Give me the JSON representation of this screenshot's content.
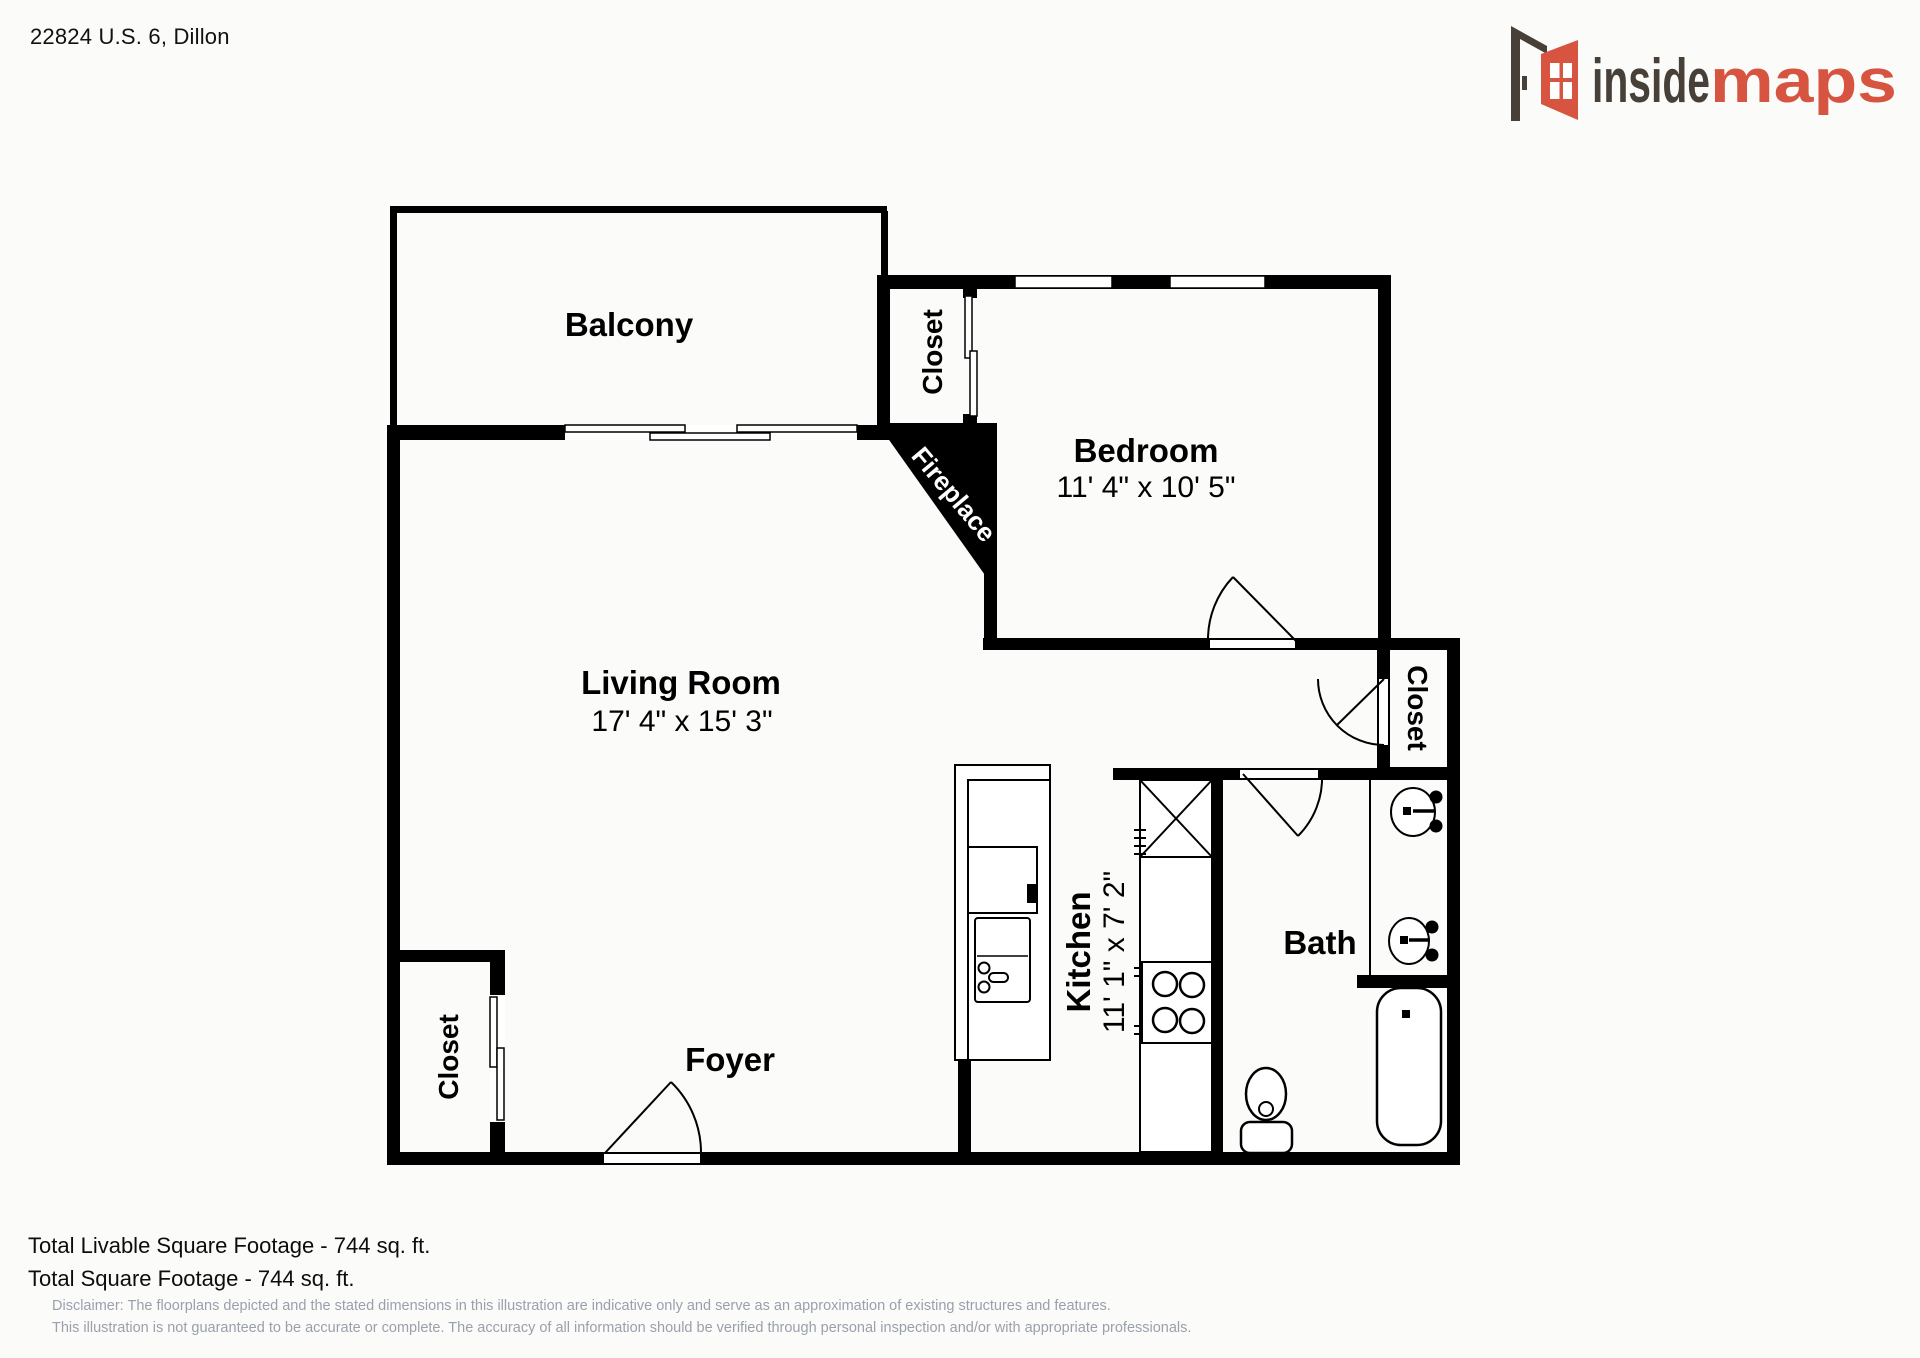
{
  "page": {
    "background": "#fbfbfa",
    "wall_color": "#000000"
  },
  "header": {
    "address": "22824 U.S. 6, Dillon",
    "logo": {
      "inside": "inside",
      "maps": "maps",
      "frame_color": "#474038",
      "accent_color": "#d75440"
    }
  },
  "plan": {
    "balcony": {
      "label": "Balcony"
    },
    "living_room": {
      "label": "Living Room",
      "dimensions": "17' 4\" x 15' 3\""
    },
    "bedroom": {
      "label": "Bedroom",
      "dimensions": "11' 4\" x 10' 5\""
    },
    "kitchen": {
      "label": "Kitchen",
      "dimensions": "11' 1\" x 7' 2\""
    },
    "bath": {
      "label": "Bath"
    },
    "foyer": {
      "label": "Foyer"
    },
    "fireplace": {
      "label": "Fireplace"
    },
    "bedroom_closet": {
      "label": "Closet"
    },
    "hall_closet": {
      "label": "Closet"
    },
    "foyer_closet": {
      "label": "Closet"
    }
  },
  "footer": {
    "livable_sqft": "Total Livable Square Footage - 744 sq. ft.",
    "total_sqft": "Total Square Footage - 744 sq. ft.",
    "disclaimer_line1": "Disclaimer: The floorplans depicted and the stated dimensions in this illustration are indicative only and serve as an approximation of existing structures and features.",
    "disclaimer_line2": "This illustration is not guaranteed to be accurate or complete. The accuracy of all information should be verified through personal inspection and/or with appropriate professionals."
  }
}
